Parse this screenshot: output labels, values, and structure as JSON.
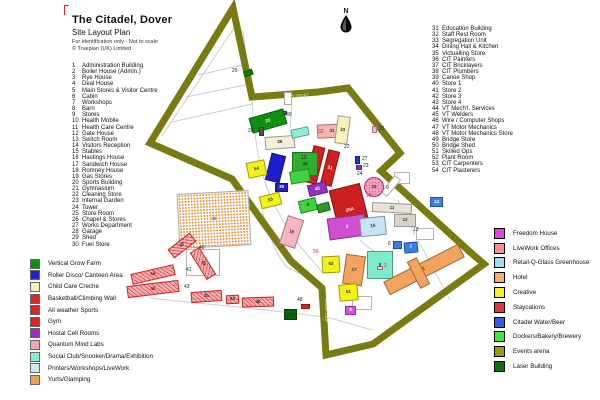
{
  "title": {
    "main": "The Citadel, Dover",
    "subtitle": "Site Layout Plan",
    "note1": "For identification only - Not to scale",
    "note2": "© Trueplan (UK) Limited"
  },
  "compass": {
    "label": "N"
  },
  "list_left": [
    {
      "n": 1,
      "label": "Administration Building"
    },
    {
      "n": 2,
      "label": "Boiler House (Admin.)"
    },
    {
      "n": 3,
      "label": "Rye House"
    },
    {
      "n": 4,
      "label": "Deal House"
    },
    {
      "n": 5,
      "label": "Main Stores & Visitor Centre"
    },
    {
      "n": 6,
      "label": "Cabin"
    },
    {
      "n": 7,
      "label": "Workshops"
    },
    {
      "n": 8,
      "label": "Barn"
    },
    {
      "n": 9,
      "label": "Stores"
    },
    {
      "n": 10,
      "label": "Health Mobile"
    },
    {
      "n": 11,
      "label": "Health Care Centre"
    },
    {
      "n": 12,
      "label": "Gate House"
    },
    {
      "n": 13,
      "label": "Switch Room"
    },
    {
      "n": 14,
      "label": "Visitors Reception"
    },
    {
      "n": 15,
      "label": "Stables"
    },
    {
      "n": 16,
      "label": "Hastings House"
    },
    {
      "n": 17,
      "label": "Sandwich House"
    },
    {
      "n": 18,
      "label": "Romney House"
    },
    {
      "n": 19,
      "label": "Gas Stores"
    },
    {
      "n": 20,
      "label": "Sports Building"
    },
    {
      "n": 21,
      "label": "Gymnasium"
    },
    {
      "n": 22,
      "label": "Cleaning Store"
    },
    {
      "n": 23,
      "label": "Internal Garden"
    },
    {
      "n": 24,
      "label": "Tower"
    },
    {
      "n": 25,
      "label": "Store Room"
    },
    {
      "n": 26,
      "label": "Chapel & Stores"
    },
    {
      "n": 27,
      "label": "Works Department"
    },
    {
      "n": 28,
      "label": "Garage"
    },
    {
      "n": 29,
      "label": "Shed"
    },
    {
      "n": 30,
      "label": "Fuel Store"
    }
  ],
  "list_right": [
    {
      "n": 31,
      "label": "Education Building"
    },
    {
      "n": 32,
      "label": "Staff Rest Room"
    },
    {
      "n": 33,
      "label": "Segregation Unit"
    },
    {
      "n": 34,
      "label": "Dining Hall & Kitchen"
    },
    {
      "n": 35,
      "label": "Victualling Store"
    },
    {
      "n": 36,
      "label": "CIT Painters"
    },
    {
      "n": 37,
      "label": "CIT Bricklayers"
    },
    {
      "n": 38,
      "label": "CIT Plumbers"
    },
    {
      "n": 39,
      "label": "Canoe Shop"
    },
    {
      "n": 40,
      "label": "Store 1"
    },
    {
      "n": 41,
      "label": "Store 2"
    },
    {
      "n": 42,
      "label": "Store 3"
    },
    {
      "n": 43,
      "label": "Store 4"
    },
    {
      "n": 44,
      "label": "VT Mech'l. Services"
    },
    {
      "n": 45,
      "label": "VT Welders"
    },
    {
      "n": 46,
      "label": "Wire / Computer Shops"
    },
    {
      "n": 47,
      "label": "VT Motor Mechanics"
    },
    {
      "n": 48,
      "label": "VT Motor Mechanics Store"
    },
    {
      "n": 49,
      "label": "Bridge Store"
    },
    {
      "n": 50,
      "label": "Bridge Shed"
    },
    {
      "n": 51,
      "label": "Skilled Ops"
    },
    {
      "n": 52,
      "label": "Plant Room"
    },
    {
      "n": 53,
      "label": "CIT Carpenters"
    },
    {
      "n": 54,
      "label": "CIT Plasterers"
    }
  ],
  "legend_left": [
    {
      "color": "#0f8f0f",
      "label": "Vertical Grow Farm"
    },
    {
      "color": "#2222cc",
      "label": "Roller Disco/ Canteen Area"
    },
    {
      "color": "#f6f1c4",
      "label": "Child Care Creche"
    },
    {
      "color": "#d92525",
      "label": "Basketball/Climbing Wall"
    },
    {
      "color": "#d92525",
      "label": "All weather Sports"
    },
    {
      "color": "#d92525",
      "label": "Gym"
    },
    {
      "color": "#9232c2",
      "label": "Hostal Cell Rooms"
    },
    {
      "color": "#f2a8bc",
      "label": "Quantum Mind Labs"
    },
    {
      "color": "#85ecd2",
      "label": "Social Club/Snooker/Drama/Exhibition"
    },
    {
      "color": "#cfe8f6",
      "label": "Printers/Workshops/LiveWork"
    },
    {
      "color": "#e8a04c",
      "label": "Yurts/Glamping"
    }
  ],
  "legend_right": [
    {
      "color": "#e145e1",
      "label": "Freedom House"
    },
    {
      "color": "#f58f8f",
      "label": "LiveWork Offices"
    },
    {
      "color": "#9fd9f2",
      "label": "Retail-Q-Glass Greenhouse"
    },
    {
      "color": "#f2b066",
      "label": "Hotel"
    },
    {
      "color": "#f2f21a",
      "label": "Creative"
    },
    {
      "color": "#e23535",
      "label": "Staycations"
    },
    {
      "color": "#3a55e8",
      "label": "Citadel Water/Beer"
    },
    {
      "color": "#3fe83f",
      "label": "Dockers/Bakery/Brewery"
    },
    {
      "color": "#9a9a10",
      "label": "Events arena"
    },
    {
      "color": "#0e6e14",
      "label": "Laser Building"
    }
  ],
  "map": {
    "wall_color": "#7a7a12",
    "wall_points": "233,8 252,97 318,92 348,88 400,153 381,171 470,252 484,264 373,344 326,355 322,288 291,261 232,179 150,143",
    "wall_labels": [
      {
        "t": "DRY MOAT",
        "x": 286,
        "y": 95,
        "r": -4
      },
      {
        "t": "DRY MOAT",
        "x": 176,
        "y": 150,
        "r": 24
      },
      {
        "t": "DRY MOAT",
        "x": 358,
        "y": 105,
        "r": 52
      },
      {
        "t": "DRY MOAT",
        "x": 316,
        "y": 308,
        "r": -90
      },
      {
        "t": "DRY MOAT",
        "x": 412,
        "y": 296,
        "r": -36
      }
    ],
    "buildings": [
      {
        "x": 178,
        "y": 192,
        "w": 72,
        "h": 55,
        "r": -3,
        "f": "#ffffff",
        "s": "#aaaaaa",
        "hatch": "orange",
        "l": "36",
        "lc": "#666666"
      },
      {
        "x": 186,
        "y": 249,
        "w": 34,
        "h": 27,
        "r": 0,
        "f": "#ffffff",
        "s": "#b5b5b5"
      },
      {
        "x": 394,
        "y": 172,
        "w": 16,
        "h": 12,
        "r": 0,
        "f": "#ffffff",
        "s": "#b5b5b5"
      },
      {
        "x": 416,
        "y": 228,
        "w": 18,
        "h": 12,
        "r": 0,
        "f": "#ffffff",
        "s": "#b5b5b5"
      },
      {
        "x": 352,
        "y": 296,
        "w": 20,
        "h": 14,
        "r": 0,
        "f": "#ffffff",
        "s": "#b5b5b5"
      },
      {
        "x": 284,
        "y": 92,
        "w": 8,
        "h": 13,
        "r": 0,
        "f": "#ffffff",
        "s": "#aaaaaa"
      },
      {
        "x": 387,
        "y": 175,
        "w": 8,
        "h": 22,
        "r": 40,
        "f": "#ffffff",
        "s": "#aaaaaa"
      },
      {
        "x": 244,
        "y": 70,
        "w": 9,
        "h": 6,
        "r": -20,
        "f": "#0c860c"
      },
      {
        "x": 250,
        "y": 113,
        "w": 36,
        "h": 16,
        "r": -16,
        "f": "#0f8f0f",
        "l": "25",
        "lc": "#eaffea"
      },
      {
        "x": 283,
        "y": 111,
        "w": 4,
        "h": 4,
        "r": 0,
        "f": "#555555"
      },
      {
        "x": 259,
        "y": 127,
        "w": 5,
        "h": 9,
        "r": 0,
        "f": "#555555"
      },
      {
        "x": 265,
        "y": 136,
        "w": 30,
        "h": 13,
        "r": -4,
        "f": "#f4efdb",
        "s": "#999999",
        "l": "26",
        "lc": "#333333"
      },
      {
        "x": 291,
        "y": 128,
        "w": 18,
        "h": 9,
        "r": -12,
        "f": "#8ff0d4"
      },
      {
        "x": 317,
        "y": 124,
        "w": 30,
        "h": 14,
        "r": -3,
        "f": "#f4b6ae",
        "l": "31",
        "lc": "#333333"
      },
      {
        "x": 336,
        "y": 116,
        "w": 13,
        "h": 28,
        "r": 8,
        "f": "#f6f2bd",
        "l": "33",
        "lc": "#333333"
      },
      {
        "x": 372,
        "y": 126,
        "w": 5,
        "h": 7,
        "r": 0,
        "f": "#f2b8c8"
      },
      {
        "x": 309,
        "y": 146,
        "w": 12,
        "h": 38,
        "r": 14,
        "f": "#cf1f1f",
        "l": "20",
        "lc": "#ffffff"
      },
      {
        "x": 324,
        "y": 150,
        "w": 12,
        "h": 36,
        "r": 14,
        "f": "#cf1f1f",
        "l": "21",
        "lc": "#ffffff"
      },
      {
        "x": 292,
        "y": 152,
        "w": 26,
        "h": 24,
        "r": 0,
        "f": "#2eb02e",
        "l": "34",
        "lc": "#0c330c"
      },
      {
        "x": 268,
        "y": 154,
        "w": 15,
        "h": 28,
        "r": 14,
        "f": "#1d1dc9"
      },
      {
        "x": 290,
        "y": 170,
        "w": 20,
        "h": 13,
        "r": -10,
        "f": "#3ed43e"
      },
      {
        "x": 247,
        "y": 161,
        "w": 19,
        "h": 16,
        "r": -12,
        "f": "#f2f218",
        "l": "54",
        "lc": "#333333"
      },
      {
        "x": 275,
        "y": 183,
        "w": 13,
        "h": 9,
        "r": 0,
        "f": "#2222bb",
        "l": "35",
        "lc": "#ffffff"
      },
      {
        "x": 260,
        "y": 194,
        "w": 21,
        "h": 13,
        "r": -14,
        "f": "#f2f218",
        "l": "53",
        "lc": "#333333"
      },
      {
        "x": 355,
        "y": 156,
        "w": 5,
        "h": 8,
        "r": 0,
        "f": "#2233cc"
      },
      {
        "x": 356,
        "y": 165,
        "w": 6,
        "h": 5,
        "r": 0,
        "f": "#8833cc"
      },
      {
        "x": 364,
        "y": 177,
        "w": 20,
        "h": 20,
        "r": 0,
        "f": "#f0a2b8",
        "s": "#c27",
        "l": "25",
        "lc": "#333333",
        "shape": "c",
        "hatch": "dots"
      },
      {
        "x": 308,
        "y": 183,
        "w": 19,
        "h": 12,
        "r": -14,
        "f": "#9232c2",
        "l": "45",
        "lc": "#ffffff"
      },
      {
        "x": 299,
        "y": 199,
        "w": 18,
        "h": 13,
        "r": -14,
        "f": "#3ed43e",
        "l": "4",
        "lc": "#0c330c"
      },
      {
        "x": 317,
        "y": 203,
        "w": 13,
        "h": 9,
        "r": -14,
        "f": "#2a9a2a"
      },
      {
        "x": 334,
        "y": 186,
        "w": 32,
        "h": 48,
        "r": -14,
        "f": "#cc2020",
        "l": "20A",
        "lc": "#ffffff"
      },
      {
        "x": 328,
        "y": 216,
        "w": 38,
        "h": 22,
        "r": -8,
        "f": "#d04fd0",
        "l": "3",
        "lc": "#ffffff"
      },
      {
        "x": 283,
        "y": 217,
        "w": 17,
        "h": 30,
        "r": 18,
        "f": "#f5b6c2",
        "l": "18",
        "lc": "#333333"
      },
      {
        "x": 360,
        "y": 217,
        "w": 26,
        "h": 19,
        "r": -6,
        "f": "#c8e4f4",
        "l": "16",
        "lc": "#333333"
      },
      {
        "x": 430,
        "y": 197,
        "w": 13,
        "h": 10,
        "r": 0,
        "f": "#3a7fe8",
        "l": "14",
        "lc": "#ffffff"
      },
      {
        "x": 372,
        "y": 203,
        "w": 40,
        "h": 10,
        "r": 3,
        "f": "#e9e2d8",
        "s": "#999999",
        "l": "11",
        "lc": "#333333"
      },
      {
        "x": 394,
        "y": 214,
        "w": 22,
        "h": 13,
        "r": 0,
        "f": "#d9d2c8",
        "s": "#999999",
        "l": "12",
        "lc": "#333333"
      },
      {
        "x": 393,
        "y": 241,
        "w": 9,
        "h": 8,
        "r": 0,
        "f": "#3a7fe8"
      },
      {
        "x": 404,
        "y": 242,
        "w": 14,
        "h": 11,
        "r": -5,
        "f": "#3a7fe8",
        "l": "7",
        "lc": "#ffffff"
      },
      {
        "x": 367,
        "y": 251,
        "w": 26,
        "h": 28,
        "r": 0,
        "f": "#7deccd",
        "l": "5",
        "lc": "#0c4433"
      },
      {
        "x": 382,
        "y": 262,
        "w": 84,
        "h": 15,
        "r": -27,
        "f": "#f2a45f",
        "l": "1",
        "lc": "#333333"
      },
      {
        "x": 413,
        "y": 258,
        "w": 11,
        "h": 30,
        "r": -27,
        "f": "#f2a45f"
      },
      {
        "x": 344,
        "y": 255,
        "w": 20,
        "h": 30,
        "r": 8,
        "f": "#f2a45f",
        "l": "17",
        "lc": "#333333"
      },
      {
        "x": 322,
        "y": 256,
        "w": 18,
        "h": 17,
        "r": -3,
        "f": "#f2f218",
        "l": "52",
        "lc": "#333333"
      },
      {
        "x": 339,
        "y": 284,
        "w": 19,
        "h": 17,
        "r": -5,
        "f": "#f2f218",
        "l": "51",
        "lc": "#333333"
      },
      {
        "x": 345,
        "y": 306,
        "w": 11,
        "h": 9,
        "r": 0,
        "f": "#d94fd9",
        "l": "8",
        "lc": "#ffffff"
      },
      {
        "x": 301,
        "y": 304,
        "w": 9,
        "h": 5,
        "r": 0,
        "f": "#dd2222"
      },
      {
        "x": 284,
        "y": 309,
        "w": 13,
        "h": 11,
        "r": 0,
        "f": "#0b5e0b"
      },
      {
        "x": 377,
        "y": 266,
        "w": 6,
        "h": 4,
        "r": 0,
        "f": "#f2b8c8"
      },
      {
        "x": 168,
        "y": 240,
        "w": 28,
        "h": 11,
        "r": -38,
        "f": "#f6b2b2",
        "s": "#cc2222",
        "hatch": "red",
        "l": "39",
        "lc": "#5a1010"
      },
      {
        "x": 187,
        "y": 258,
        "w": 32,
        "h": 11,
        "r": 58,
        "f": "#f6b2b2",
        "s": "#cc2222",
        "hatch": "red",
        "l": "42",
        "lc": "#5a1010"
      },
      {
        "x": 131,
        "y": 269,
        "w": 44,
        "h": 11,
        "r": -13,
        "f": "#f6b2b2",
        "s": "#cc2222",
        "hatch": "red",
        "l": "44",
        "lc": "#5a1010"
      },
      {
        "x": 127,
        "y": 283,
        "w": 52,
        "h": 12,
        "r": -7,
        "f": "#f6b2b2",
        "s": "#cc2222",
        "hatch": "red",
        "l": "45",
        "lc": "#5a1010"
      },
      {
        "x": 191,
        "y": 291,
        "w": 31,
        "h": 11,
        "r": -4,
        "f": "#f6b2b2",
        "s": "#cc2222",
        "hatch": "red",
        "l": "35",
        "lc": "#5a1010"
      },
      {
        "x": 226,
        "y": 295,
        "w": 13,
        "h": 9,
        "r": -3,
        "f": "#f6b2b2",
        "s": "#cc2222",
        "hatch": "red",
        "l": "33",
        "lc": "#5a1010"
      },
      {
        "x": 242,
        "y": 297,
        "w": 32,
        "h": 10,
        "r": -2,
        "f": "#f6b2b2",
        "s": "#cc2222",
        "hatch": "red",
        "l": "46",
        "lc": "#5a1010"
      }
    ],
    "labels": [
      {
        "t": "29",
        "x": 232,
        "y": 69
      },
      {
        "t": "30",
        "x": 286,
        "y": 113
      },
      {
        "t": "28",
        "x": 248,
        "y": 129
      },
      {
        "t": "32",
        "x": 318,
        "y": 130,
        "c": "#cc2222"
      },
      {
        "t": "15",
        "x": 379,
        "y": 127
      },
      {
        "t": "22",
        "x": 344,
        "y": 145
      },
      {
        "t": "19",
        "x": 301,
        "y": 156
      },
      {
        "t": "27",
        "x": 362,
        "y": 157
      },
      {
        "t": "23",
        "x": 363,
        "y": 164
      },
      {
        "t": "24",
        "x": 357,
        "y": 172
      },
      {
        "t": "9",
        "x": 386,
        "y": 186
      },
      {
        "t": "10",
        "x": 366,
        "y": 194,
        "c": "#cc2222"
      },
      {
        "t": "13",
        "x": 413,
        "y": 228
      },
      {
        "t": "6",
        "x": 388,
        "y": 242
      },
      {
        "t": "2",
        "x": 384,
        "y": 264,
        "c": "#cc2222"
      },
      {
        "t": "50",
        "x": 313,
        "y": 250,
        "c": "#cc2222"
      },
      {
        "t": "48",
        "x": 297,
        "y": 298
      },
      {
        "t": "40",
        "x": 199,
        "y": 246
      },
      {
        "t": "41",
        "x": 186,
        "y": 268
      },
      {
        "t": "43",
        "x": 184,
        "y": 285
      }
    ]
  }
}
